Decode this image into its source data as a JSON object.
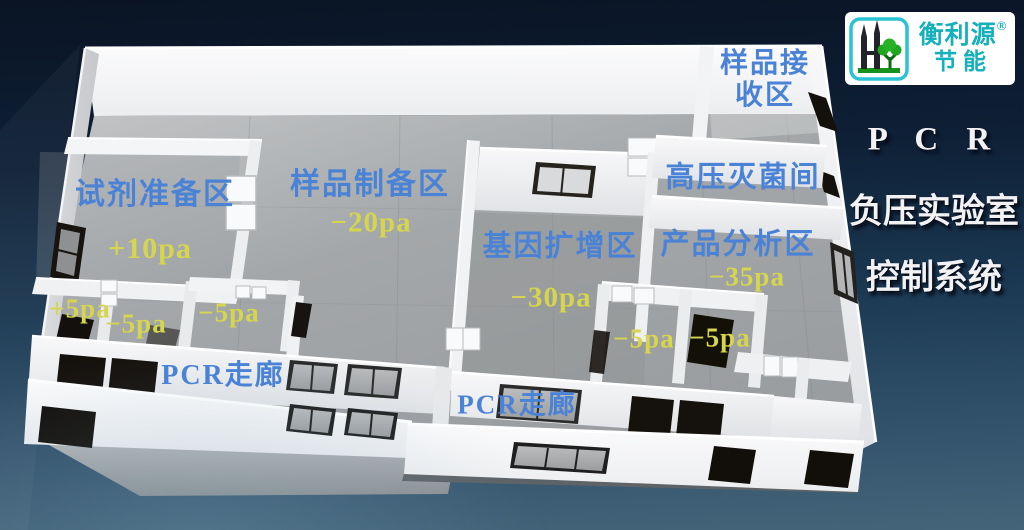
{
  "brand": {
    "name": "衡利源",
    "reg_mark": "®",
    "subtitle": "节能"
  },
  "title": {
    "line1": "P C R",
    "line2": "负压实验室",
    "line3": "控制系统"
  },
  "rooms": {
    "reagent": {
      "label": "试剂准备区",
      "pressure": "+10pa"
    },
    "sample_prep": {
      "label": "样品制备区",
      "pressure": "−20pa"
    },
    "gene_amp": {
      "label": "基因扩增区",
      "pressure": "−30pa"
    },
    "product_analysis": {
      "label": "产品分析区",
      "pressure": "−35pa"
    },
    "autoclave": {
      "label": "高压灭菌间"
    },
    "sample_receiving": {
      "label": "样品接收区"
    }
  },
  "buffer_pressures": [
    "+5pa",
    "−5pa",
    "−5pa",
    "−5pa",
    "−5pa"
  ],
  "corridors": {
    "upper": "PCR走廊",
    "lower": "PCR走廊"
  },
  "colors": {
    "room_label": "#4a82d6",
    "pressure_label": "#d5d54e",
    "title_text": "#f2f2f4",
    "brand_teal": "#14b0bc",
    "background_top": "#0a1424",
    "background_bottom": "#446579"
  }
}
